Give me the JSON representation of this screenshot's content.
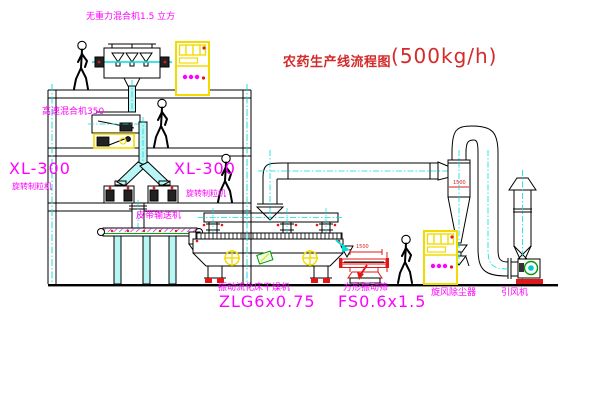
{
  "title": {
    "name": "农药生产线流程图",
    "capacity": "(500kg/h)"
  },
  "labels": {
    "mixer_top": "无重力混合机1.5 立方",
    "high_speed_mixer": "高速混合机350",
    "xl_model_left": "XL-300",
    "granulator_name_left": "旋转制粒机",
    "xl_model_right": "XL-300",
    "granulator_name_right": "旋转制粒机",
    "belt_conveyor": "皮带输送机",
    "dryer_name": "振动流化床干燥机",
    "dryer_model": "ZLG6x0.75",
    "sieve_name": "方形振动筛",
    "sieve_model": "FS0.6x1.5",
    "cyclone_name": "旋风除尘器",
    "fan_name": "引风机"
  },
  "dimensions": {
    "sieve_length": "1500",
    "cyclone_width": "1500"
  },
  "colors": {
    "label_magenta": "#ff00ff",
    "title_red": "#d42a2a",
    "line_black": "#000000",
    "centerline_cyan": "#00dede",
    "fill_cyan": "#b8f6f6",
    "cabinet_yellow": "#f2dc00",
    "status_red": "#e01818",
    "fan_green": "#009900",
    "background": "#ffffff"
  }
}
